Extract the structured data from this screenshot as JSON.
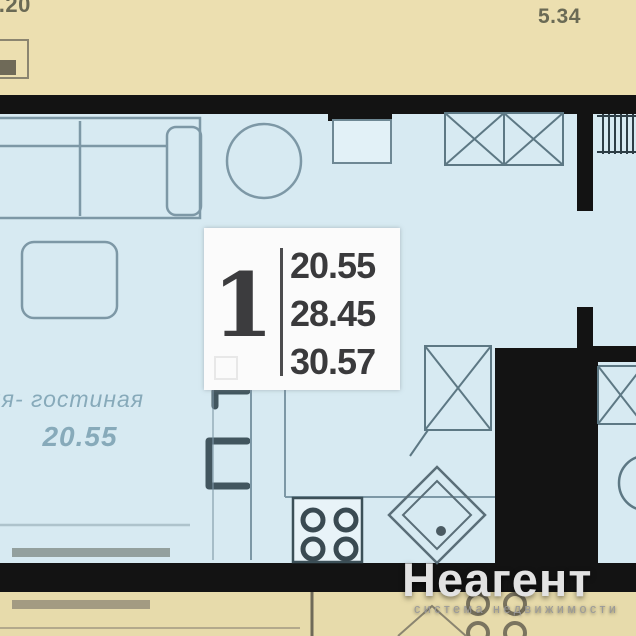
{
  "plan": {
    "type": "apartment-floor-plan",
    "dimension_labels": {
      "top_left": "0.20",
      "top_right": "5.34"
    },
    "info_box": {
      "room_count": "1",
      "areas": [
        "20.55",
        "28.45",
        "30.57"
      ]
    },
    "room": {
      "label": "ня- гостиная",
      "area": "20.55"
    },
    "furniture_icons": [
      "sofa",
      "coffee-table",
      "round-table",
      "wardrobe",
      "vent-duct",
      "hatched-shaft",
      "fridge",
      "bar-stools",
      "kitchen-counter",
      "stove",
      "sink",
      "neighbor-wardrobe",
      "neighbor-basin"
    ]
  },
  "watermark": {
    "logo": "Неагент",
    "tagline": "система недвижимости"
  },
  "colors": {
    "wall": "#131313",
    "interior": "#d7eaf2",
    "exterior": "#ecdfb0",
    "furniture_line": "#7d98a6",
    "dark_symbol": "#3c5058",
    "info_text": "#3a3a3c",
    "room_label": "#87aaba",
    "dimension_text": "#6a6a55",
    "watermark_text": "#e2e2e2"
  }
}
